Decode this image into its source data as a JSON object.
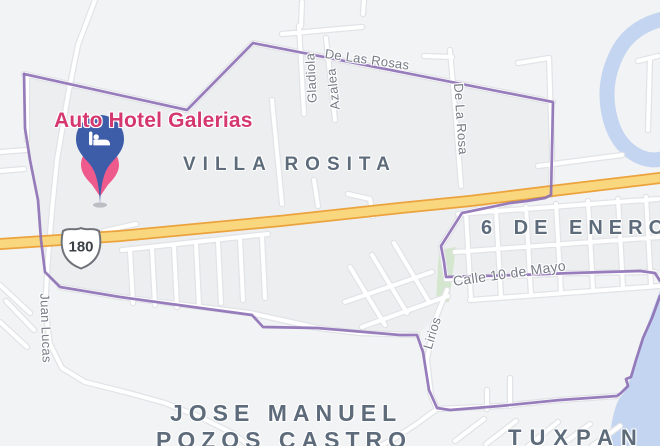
{
  "map": {
    "poi": {
      "name": "Auto Hotel Galerias"
    },
    "route_shield": {
      "number": "180"
    },
    "neighborhoods": {
      "villa_rosita": "VILLA ROSITA",
      "seis_de_enero": "6 DE ENERO",
      "jose_manuel_line1": "JOSE MANUEL",
      "jose_manuel_line2": "POZOS CASTRO",
      "tuxpan": "TUXPAN"
    },
    "streets": {
      "de_las_rosas": "De Las Rosas",
      "gladiola": "Gladiola",
      "azalea": "Azalea",
      "de_la_rosa": "De La Rosa",
      "calle_10_de_mayo": "Calle 10 de Mayo",
      "lirios": "Lirios",
      "juan_lucas": "Juan Lucas"
    },
    "colors": {
      "poi_label": "#D5386F",
      "pin_blue": "#3D5DA9",
      "pin_pink": "#EE5A8B",
      "boundary_purple": "#8C6FB4",
      "highway_fill": "#F9D77E",
      "highway_casing": "#ECA33D",
      "water": "#C4D5F1",
      "neighborhood_label": "#5D6B7B",
      "street_label": "#767B85",
      "background": "#F2F3F5"
    }
  }
}
